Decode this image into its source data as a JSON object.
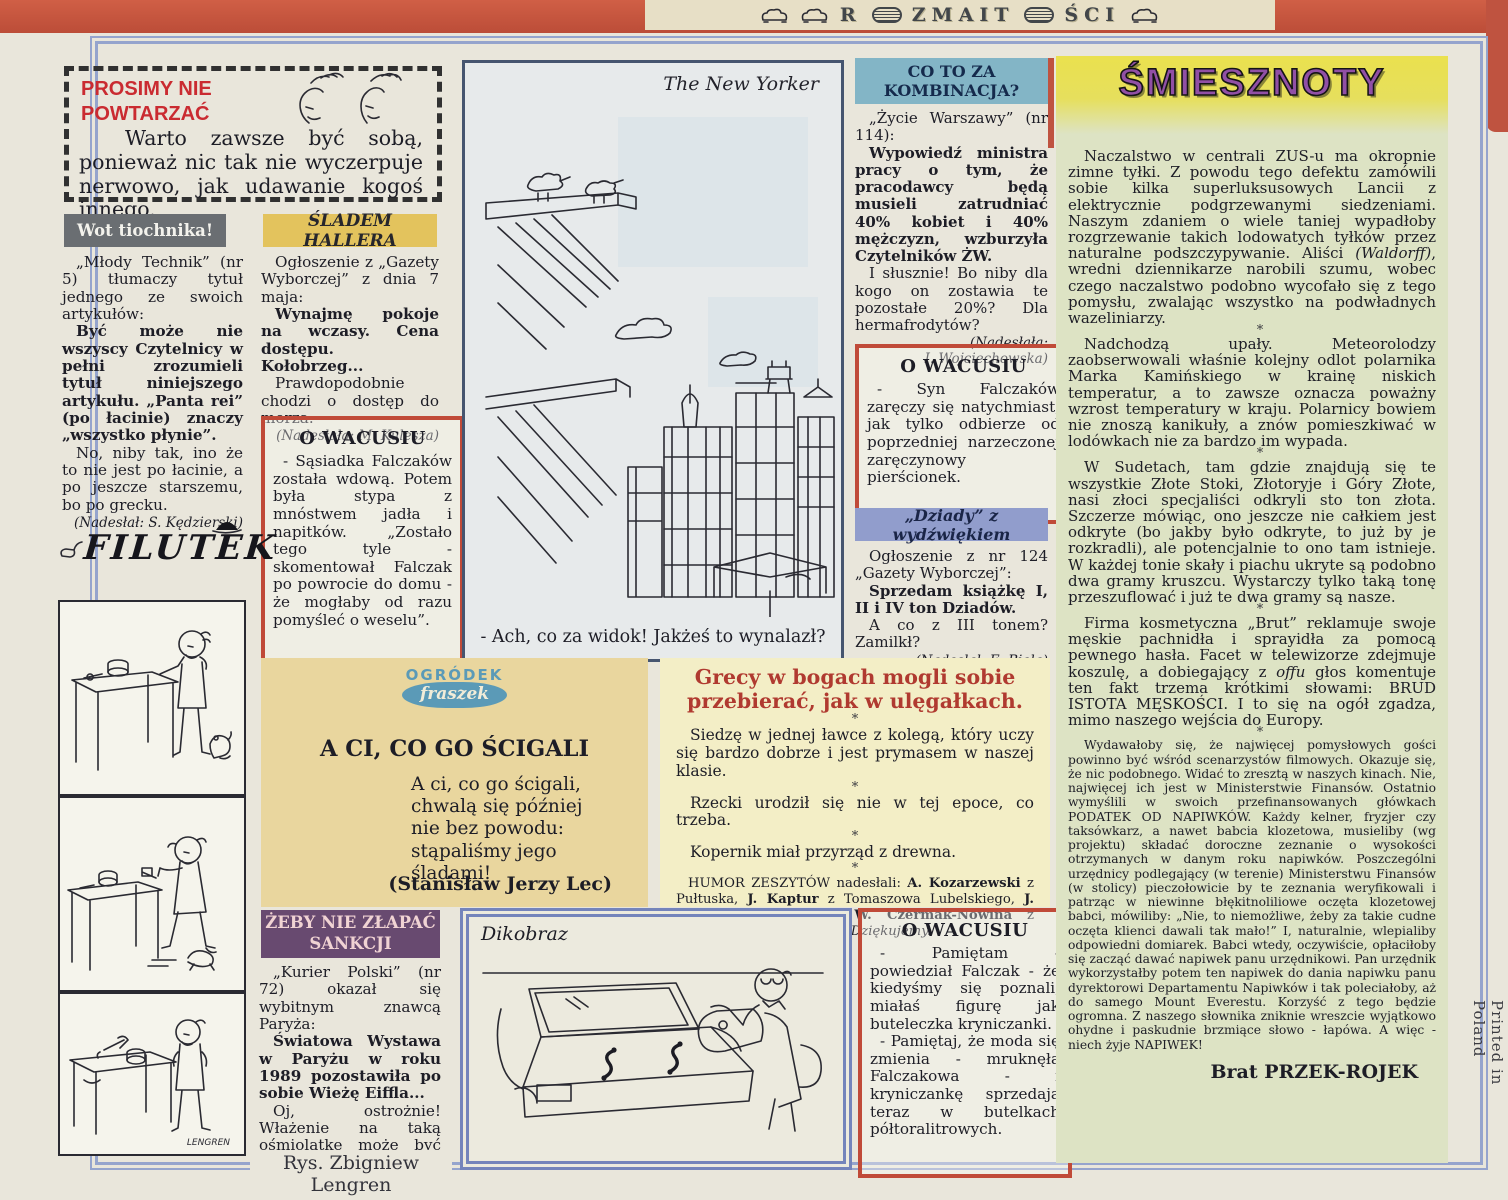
{
  "masthead": {
    "letters_left": "R",
    "letters_mid": "ZMAIT",
    "letters_right": "ŚCI"
  },
  "page": {
    "printed_in": "Printed in Poland",
    "artist_credit": "Rys. Zbigniew Lengren"
  },
  "prosimy": {
    "title_line1": "PROSIMY NIE",
    "title_line2": "POWTARZAĆ",
    "body": "Warto zawsze być sobą, ponieważ nic tak nie wyczerpuje nerwowo, jak udawanie kogoś innego."
  },
  "wot": {
    "header": "Wot tiochnika!",
    "p1": "„Młody Technik” (nr 5) tłumaczy tytuł jednego ze swoich artykułów:",
    "p2": "Być może nie wszyscy Czytelnicy w pełni zrozumieli tytuł niniejszego artykułu. „Panta rei” (po łacinie) znaczy „wszystko płynie”.",
    "p3": "No, niby tak, ino że to nie jest po łacinie, a po jeszcze starszemu, bo po grecku.",
    "credit": "(Nadesłał: S. Kędzierski)"
  },
  "sladem": {
    "header": "ŚLADEM HALLERA",
    "p1": "Ogłoszenie z „Gazety Wyborczej” z dnia 7 maja:",
    "p2": "Wynajmę pokoje na wczasy. Cena dostępu. Kołobrzeg...",
    "p3": "Prawdopodobnie chodzi o dostęp do morza.",
    "credit": "(Nadesłała: M. Kulesza)"
  },
  "wacus1": {
    "header": "O WACUSIU",
    "body": "- Sąsiadka Falczaków została wdową. Potem była stypa z mnóstwem jadła i napitków. „Zostało tego tyle - skomentował Falczak po powrocie do domu - że mogłaby od razu pomyśleć o weselu”."
  },
  "filutek": {
    "logo": "FILUTEK",
    "signature": "LENGREN"
  },
  "newyorker": {
    "source": "The New Yorker",
    "caption": "- Ach, co za widok! Jakżeś to wynalazł?"
  },
  "kombinacja": {
    "header_line1": "CO TO ZA",
    "header_line2": "KOMBINACJA?",
    "p1": "„Życie Warszawy” (nr 114):",
    "p2": "Wypowiedź ministra pracy o tym, że pracodawcy będą musieli zatrudniać 40% kobiet i 40% mężczyzn, wzburzyła Czytelników ŻW.",
    "p3": "I słusznie! Bo niby dla kogo on zostawia te pozostałe 20%? Dla hermafrodytów?",
    "credit_line1": "(Nadesłała:",
    "credit_line2": "I. Wojciechowska)"
  },
  "wacus2": {
    "header": "O WACUSIU",
    "body": "- Syn Falczaków zaręczy się natychmiast, jak tylko odbierze od poprzedniej narzeczonej zaręczynowy pierścionek."
  },
  "dziady": {
    "header": "„Dziady” z wydźwiękiem",
    "p1": "Ogłoszenie z nr 124 „Gazety Wyborczej”:",
    "p2": "Sprzedam książkę I, II i IV ton Dziadów.",
    "p3": "A co z III tonem? Zamilkł?",
    "credit": "(Nadesłał: E. Biela)"
  },
  "ogrodek": {
    "logo_line1": "OGRÓDEK",
    "logo_line2": "fraszek",
    "title": "A CI, CO GO ŚCIGALI",
    "poem_lines": [
      "A ci, co go ścigali,",
      "chwalą się później",
      "nie bez powodu:",
      "stąpaliśmy jego",
      "śladami!"
    ],
    "author": "(Stanisław Jerzy Lec)"
  },
  "humor": {
    "headline": "Grecy w bogach mogli sobie przebierać, jak w ulęgałkach.",
    "separator": "*",
    "item1": "Siedzę w jednej ławce z kolegą, który uczy się bardzo dobrze i jest prymasem w naszej klasie.",
    "item2": "Rzecki urodził się nie w tej epoce, co trzeba.",
    "item3": "Kopernik miał przyrząd z drewna.",
    "credits": [
      {
        "t": "HUMOR ZESZYTÓW nadesłali: "
      },
      {
        "t": "A. Kozarzewski",
        "b": 1
      },
      {
        "t": " z Pułtuska, "
      },
      {
        "t": "J. Kaptur",
        "b": 1
      },
      {
        "t": " z Tomaszowa Lubelskiego, "
      },
      {
        "t": "J. Bilska",
        "b": 1
      },
      {
        "t": " z Radzynia i "
      },
      {
        "t": "W. Czermak-Nowina",
        "b": 1
      },
      {
        "t": " z Lidzbarku Warmińskiego. "
      },
      {
        "t": "Dziękujemy.",
        "i": 1
      }
    ]
  },
  "zeby": {
    "header_line1": "ŻEBY NIE ZŁAPAĆ",
    "header_line2": "SANKCJI",
    "p1": "„Kurier Polski” (nr 72) okazał się wybitnym znawcą Paryża:",
    "p2": "Światowa Wystawa w Paryżu w roku 1989 pozostawiła po sobie Wieżę Eiffla...",
    "p3": "Oj, ostrożnie! Włażenie na taką ośmiolatkę może być źle widziane.",
    "credit": "(Nadesłał: A. Mikulski)"
  },
  "dikobraz": {
    "source": "Dikobraz"
  },
  "wacus3": {
    "header": "O WACUSIU",
    "p1": "- Pamiętam - powiedział Falczak - że kiedyśmy się poznali, miałaś figurę jak buteleczka kryniczanki.",
    "p2": "- Pamiętaj, że moda się zmienia - mruknęła Falczakowa - i kryniczankę sprzedają teraz w butelkach półtoralitrowych."
  },
  "smiesznoty": {
    "title": "ŚMIESZNOTY",
    "separator": "*",
    "signature": "Brat PRZEK-ROJEK",
    "paragraphs": [
      [
        {
          "t": "Naczalstwo w centrali ZUS-u ma okropnie zimne tyłki. Z powodu tego defektu zamówili sobie kilka superluksusowych Lancii z elektrycznie podgrzewanymi siedzeniami. Naszym zdaniem o wiele taniej wypadłoby rozgrzewanie takich lodowatych tyłków przez naturalne podszczypywanie. Aliści "
        },
        {
          "t": "(Waldorff)",
          "i": 1
        },
        {
          "t": ", wredni dziennikarze narobili szumu, wobec czego naczalstwo podobno wycofało się z tego pomysłu, zwalając wszystko na podwładnych wazeliniarzy."
        }
      ],
      [
        {
          "t": "Nadchodzą upały. Meteorolodzy zaobserwowali właśnie kolejny odlot polarnika Marka Kamińskiego w krainę niskich temperatur, a to zawsze oznacza poważny wzrost temperatury w kraju. Polarnicy bowiem nie znoszą kanikuły, a znów pomieszkiwać w lodówkach nie za bardzo im wypada."
        }
      ],
      [
        {
          "t": "W Sudetach, tam gdzie znajdują się te wszystkie Złote Stoki, Złotoryje i Góry Złote, nasi złoci specjaliści odkryli sto ton złota. Szczerze mówiąc, ono jeszcze nie całkiem jest odkryte (bo jakby było odkryte, to już by je rozkradli), ale potencjalnie to ono tam istnieje. W każdej tonie skały i piachu ukryte są podobno dwa gramy kruszcu. Wystarczy tylko taką tonę przeszuflować i już te dwa gramy są nasze."
        }
      ],
      [
        {
          "t": "Firma kosmetyczna „Brut” reklamuje swoje męskie pachnidła i sprayidła za pomocą pewnego hasła. Facet w telewizorze zdejmuje koszulę, a dobiegający z "
        },
        {
          "t": "offu",
          "i": 1
        },
        {
          "t": " głos komentuje ten fakt trzema krótkimi słowami: BRUD ISTOTA MĘSKOŚCI. I to się na ogół zgadza, mimo naszego wejścia do Europy."
        }
      ],
      [
        {
          "t": "Wydawałoby się, że najwięcej pomysłowych gości powinno być wśród scenarzystów filmowych. Okazuje się, że nic podobnego. Widać to zresztą w naszych kinach. Nie, najwięcej ich jest w Ministerstwie Finansów. Ostatnio wymyślili w swoich przefinansowanych główkach PODATEK OD NAPIWKÓW. Każdy kelner, fryzjer czy taksówkarz, a nawet babcia klozetowa, musieliby (wg projektu) składać doroczne zeznanie o wysokości otrzymanych w danym roku napiwków. Poszczególni urzędnicy podlegający (w terenie) Ministerstwu Finansów (w stolicy) pieczołowicie by te zeznania weryfikowali i patrząc w niewinne błękitnoliliowe oczęta klozetowej babci, mówiliby: „Nie, to niemożliwe, żeby za takie cudne oczęta klienci dawali tak mało!” I, naturalnie, wlepialiby odpowiedni domiarek. Babci wtedy, oczywiście, opłaciłoby się zacząć dawać napiwek panu urzędnikowi. Pan urzędnik wykorzystałby potem ten napiwek do dania napiwku panu dyrektorowi Departamentu Napiwków i tak poleciałoby, aż do samego Mount Everestu. Korzyść z tego będzie ogromna. Z naszego słownika zniknie wreszcie wyjątkowo ohydne i paskudnie brzmiące słowo - łapówa. A więc - niech żyje NAPIWEK!"
        }
      ]
    ]
  }
}
